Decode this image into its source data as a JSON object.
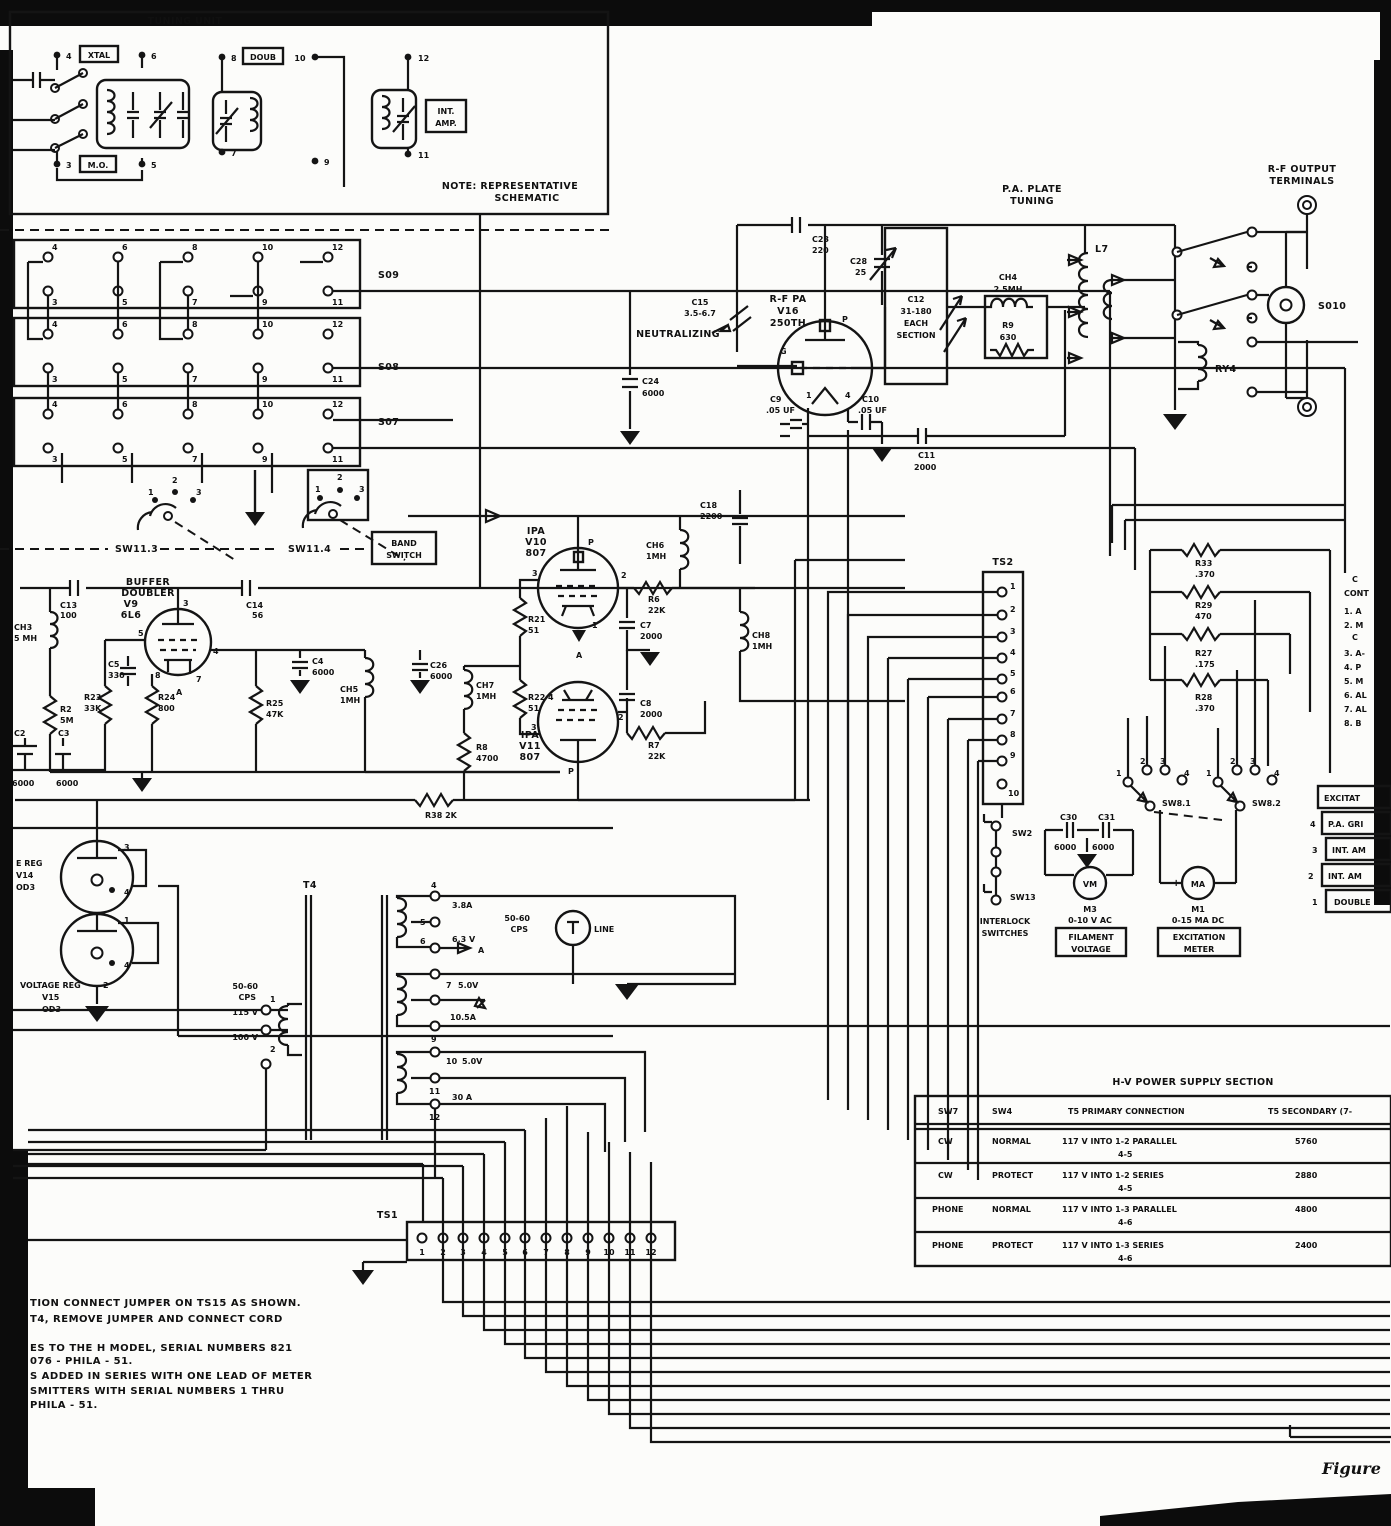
{
  "figure": {
    "caption": "Figure"
  },
  "nums": {
    "n1": "1",
    "n2": "2",
    "n3": "3",
    "n4": "4",
    "n5": "5",
    "n6": "6",
    "n7": "7",
    "n8": "8",
    "n9": "9",
    "n10": "10",
    "n11": "11",
    "n12": "12"
  },
  "tuning_unit": {
    "title": "TUNING UNIT",
    "xtal": "XTAL",
    "doub": "DOUB",
    "int1": "INT.",
    "int2": "AMP.",
    "mo": "M.O.",
    "note1": "NOTE: REPRESENTATIVE",
    "note2": "SCHEMATIC"
  },
  "sockets": {
    "s09": "S09",
    "s08": "S08",
    "s07": "S07"
  },
  "band_switch": {
    "sw113": "SW11.3",
    "sw114": "SW11.4",
    "b1": "BAND",
    "b2": "SWITCH"
  },
  "buffer": {
    "t1": "BUFFER",
    "t2": "DOUBLER",
    "t3": "V9",
    "t4": "6L6",
    "c13n": "C13",
    "c13v": "100",
    "ch3n": "CH3",
    "ch3v": "5 MH",
    "r2n": "R2",
    "r2v": "5M",
    "c2n": "C2",
    "c2v": "6000",
    "c3n": "C3",
    "c3v": "6000",
    "c5n": "C5",
    "c5v": "330",
    "r23n": "R23",
    "r23v": "33K",
    "r24n": "R24",
    "r24v": "800",
    "c14n": "C14",
    "c14v": "56",
    "c4n": "C4",
    "c4v": "6000",
    "r25n": "R25",
    "r25v": "47K",
    "ch5n": "CH5",
    "ch5v": "1MH",
    "c26n": "C26",
    "c26v": "6000",
    "r38": "R38 2K",
    "a": "A"
  },
  "ipa": {
    "v10a": "IPA",
    "v10b": "V10",
    "v10c": "807",
    "v11a": "IPA",
    "v11b": "V11",
    "v11c": "807",
    "ch6n": "CH6",
    "ch6v": "1MH",
    "ch7n": "CH7",
    "ch7v": "1MH",
    "ch8n": "CH8",
    "ch8v": "1MH",
    "r21n": "R21",
    "r21v": "51",
    "r22n": "R22",
    "r22v": "51",
    "r6n": "R6",
    "r6v": "22K",
    "r7n": "R7",
    "r7v": "22K",
    "c7n": "C7",
    "c7v": "2000",
    "c8n": "C8",
    "c8v": "2000",
    "r8n": "R8",
    "r8v": "4700",
    "c18n": "C18",
    "c18v": "2200",
    "p": "P",
    "a": "A"
  },
  "pa": {
    "v16a": "R-F PA",
    "v16b": "V16",
    "v16c": "250TH",
    "g": "G",
    "p": "P",
    "neut": "NEUTRALIZING",
    "c15n": "C15",
    "c15v": "3.5-6.7",
    "c23n": "C23",
    "c23v": "220",
    "c28n": "C28",
    "c28v": "25",
    "c12a": "C12",
    "c12b": "31-180",
    "c12c": "EACH",
    "c12d": "SECTION",
    "ch4n": "CH4",
    "ch4v": "2.5MH",
    "r9n": "R9",
    "r9v": "630",
    "c24n": "C24",
    "c24v": "6000",
    "c9n": "C9",
    "c9v": ".05 UF",
    "c10n": "C10",
    "c10v": ".05 UF",
    "c11n": "C11",
    "c11v": "2000",
    "plate1": "P.A. PLATE",
    "plate2": "TUNING"
  },
  "output": {
    "l7": "L7",
    "ry4": "RY4",
    "s010": "S010",
    "out1": "R-F OUTPUT",
    "out2": "TERMINALS"
  },
  "ts2": {
    "label": "TS2"
  },
  "interlock": {
    "sw2": "SW2",
    "sw13": "SW13",
    "il1": "INTERLOCK",
    "il2": "SWITCHES"
  },
  "caps": {
    "c30": "C30",
    "c31": "C31",
    "v30": "6000",
    "v31": "6000"
  },
  "meters": {
    "vm": "VM",
    "m3": "M3",
    "m3r": "0-10 V AC",
    "f1": "FILAMENT",
    "f2": "VOLTAGE",
    "ma": "MA",
    "plus": "+",
    "minus": "-",
    "m1": "M1",
    "m1r": "0-15 MA DC",
    "e1": "EXCITATION",
    "e2": "METER"
  },
  "sw8": {
    "a": "SW8.1",
    "b": "SW8.2"
  },
  "rstack": {
    "r33n": "R33",
    "r33v": ".370",
    "r29n": "R29",
    "r29v": "470",
    "r27n": "R27",
    "r27v": ".175",
    "r28n": "R28",
    "r28v": ".370"
  },
  "legend": {
    "lines": [
      "C",
      "CONT",
      "1. A",
      "2. M",
      "C",
      "3. A-",
      "4. P",
      "5. M",
      "6. AL",
      "7. AL",
      "8. B"
    ],
    "ex_header": "EXCITAT",
    "ex_rows": [
      [
        "4",
        "P.A. GRI"
      ],
      [
        "3",
        "INT. AM"
      ],
      [
        "2",
        "INT. AM"
      ],
      [
        "1",
        "DOUBLE"
      ]
    ]
  },
  "regulators": {
    "r1a": "E REG",
    "r1b": "V14",
    "r1c": "OD3",
    "r2a": "VOLTAGE REG",
    "r2b": "V15",
    "r2c": "OD3"
  },
  "t4": {
    "label": "T4",
    "cps1": "50-60",
    "cps2": "CPS",
    "v115": "115 V",
    "v100": "100 V",
    "a1": "3.8A",
    "v63": "6.3 V",
    "amark": "A",
    "w2v": "5.0V",
    "a2": "10.5A",
    "w3v": "5.0V",
    "a3": "30 A",
    "lamp": "LINE",
    "cps3": "50-60",
    "cps4": "CPS"
  },
  "hv": {
    "title": "H-V POWER SUPPLY SECTION",
    "h": [
      "SW7",
      "SW4",
      "T5 PRIMARY CONNECTION",
      "T5 SECONDARY (7-"
    ],
    "rows": [
      [
        "CW",
        "NORMAL",
        "117 V INTO 1-2 PARALLEL",
        "4-5",
        "5760"
      ],
      [
        "CW",
        "PROTECT",
        "117 V INTO 1-2 SERIES",
        "4-5",
        "2880"
      ],
      [
        "PHONE",
        "NORMAL",
        "117 V INTO 1-3 PARALLEL",
        "4-6",
        "4800"
      ],
      [
        "PHONE",
        "PROTECT",
        "117 V INTO 1-3 SERIES",
        "4-6",
        "2400"
      ]
    ]
  },
  "ts1": {
    "label": "TS1"
  },
  "notes": {
    "lines": [
      "TION  CONNECT JUMPER ON TS15 AS SHOWN.",
      "T4, REMOVE JUMPER AND CONNECT CORD",
      "ES TO THE  H MODEL, SERIAL NUMBERS  821",
      "076 - PHILA - 51.",
      "S ADDED IN SERIES  WITH ONE LEAD OF METER",
      "SMITTERS  WITH  SERIAL  NUMBERS  1 THRU",
      "PHILA - 51."
    ]
  }
}
